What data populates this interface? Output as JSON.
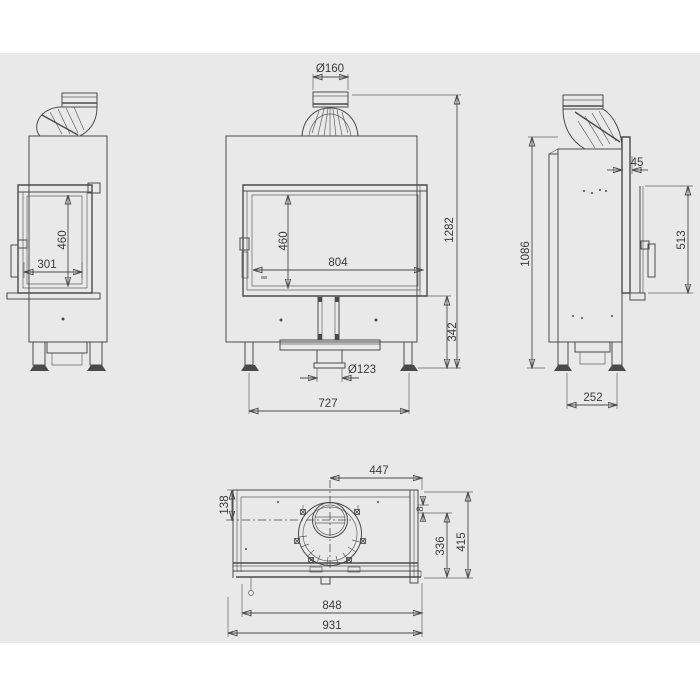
{
  "colors": {
    "page": "#ffffff",
    "canvas": "#e9e9e9",
    "line": "#4a4a4a",
    "text": "#3a3a3a"
  },
  "views": {
    "front": {
      "dims": {
        "flue_diameter": "Ø160",
        "total_height": "1282",
        "glass_height": "460",
        "glass_width": "804",
        "base_height": "342",
        "air_inlet_diameter": "Ø123",
        "feet_span": "727"
      }
    },
    "left_side": {
      "dims": {
        "glass_width": "301",
        "glass_height": "460"
      }
    },
    "right_side": {
      "dims": {
        "door_frame_depth": "45",
        "door_height": "513",
        "body_height": "1086",
        "feet_span": "252"
      }
    },
    "top": {
      "dims": {
        "flue_center_from_right": "447",
        "flue_center_from_back": "138",
        "glass_offset": "8",
        "side_depth": "336",
        "total_depth": "415",
        "glass_width": "848",
        "total_width": "931"
      }
    }
  }
}
